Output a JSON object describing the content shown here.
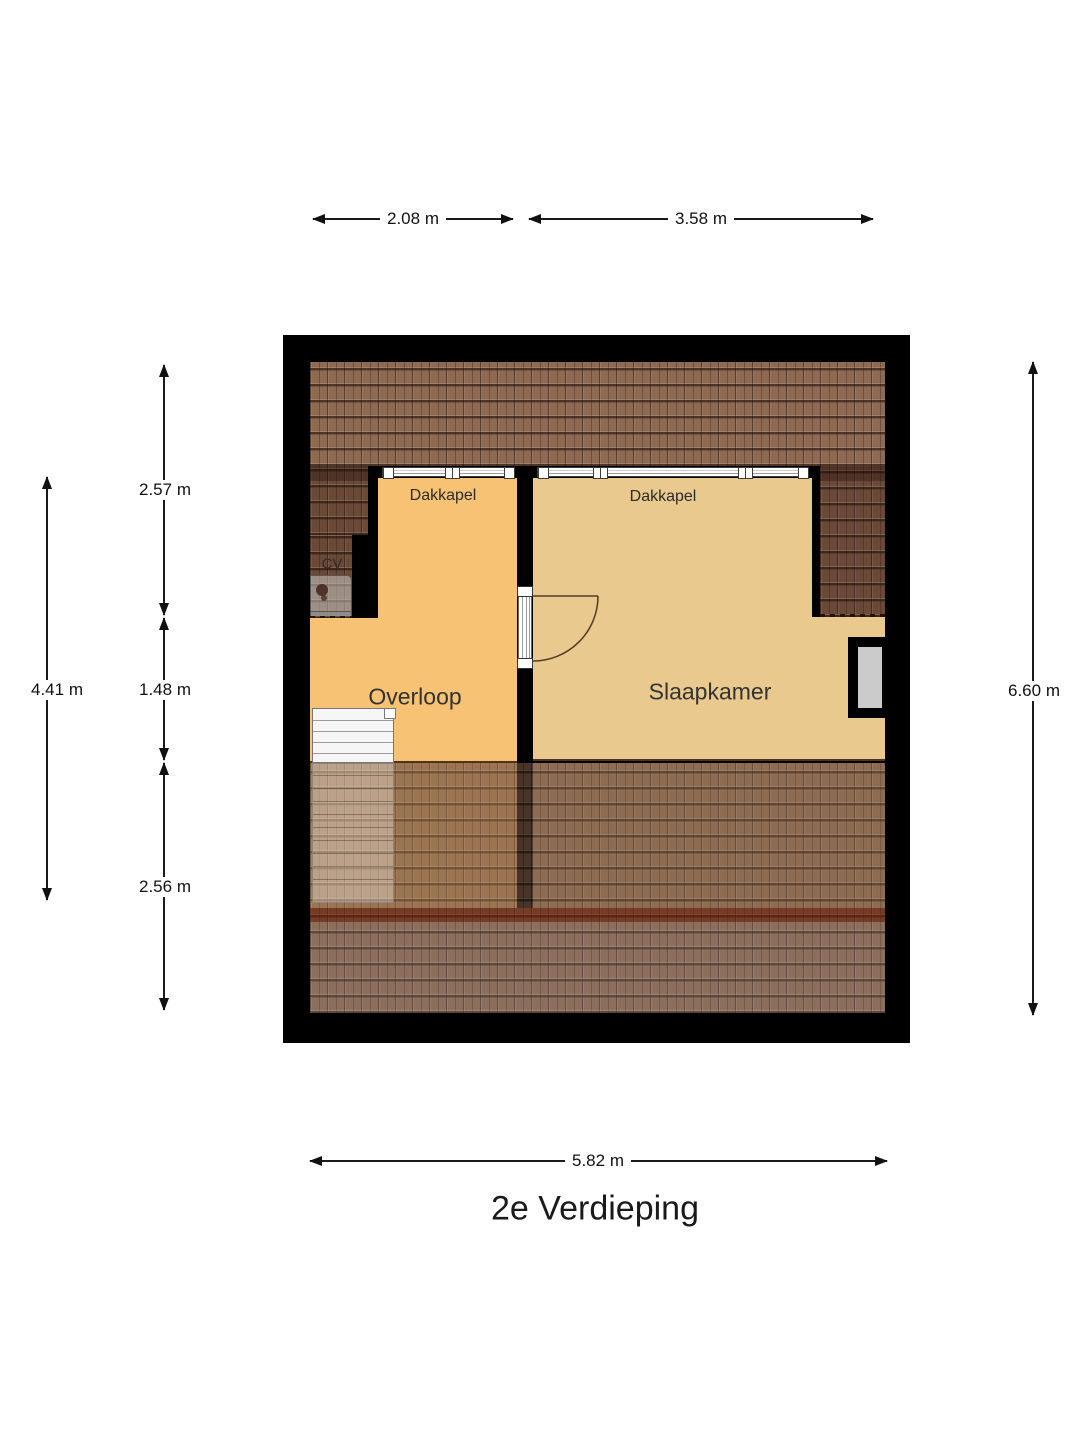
{
  "title": "2e Verdieping",
  "rooms": {
    "dormer_left_label": "Dakkapel",
    "dormer_right_label": "Dakkapel",
    "cv_label": "CV",
    "landing_label": "Overloop",
    "bedroom_label": "Slaapkamer"
  },
  "dimensions": {
    "top_left": "2.08 m",
    "top_right": "3.58 m",
    "bottom": "5.82 m",
    "right": "6.60 m",
    "left_outer": "4.41 m",
    "left_upper": "2.57 m",
    "left_middle": "1.48 m",
    "left_lower": "2.56 m"
  },
  "colors": {
    "wall": "#000000",
    "floor_landing": "#f7c273",
    "floor_bedroom": "#eac98f",
    "roof": "#8e6a52",
    "roof_shadow": "#6a4a37",
    "roof_bottom": "#7d5b46",
    "eave_band": "#6e2310",
    "niche_fill": "#cbcbcb",
    "stairs": "#f6f6f6"
  }
}
